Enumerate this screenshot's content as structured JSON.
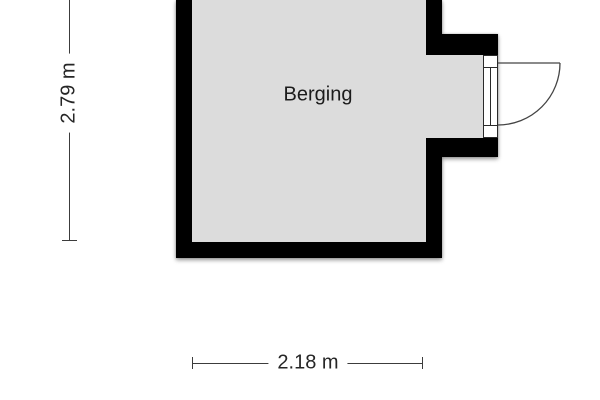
{
  "floor_plan": {
    "room": {
      "label": "Berging"
    },
    "dimensions": {
      "height_label": "2.79 m",
      "width_label": "2.18 m"
    },
    "colors": {
      "wall": "#000000",
      "floor": "#dcdcdc",
      "dimension_line": "#3c3c3c",
      "background": "#ffffff"
    }
  }
}
